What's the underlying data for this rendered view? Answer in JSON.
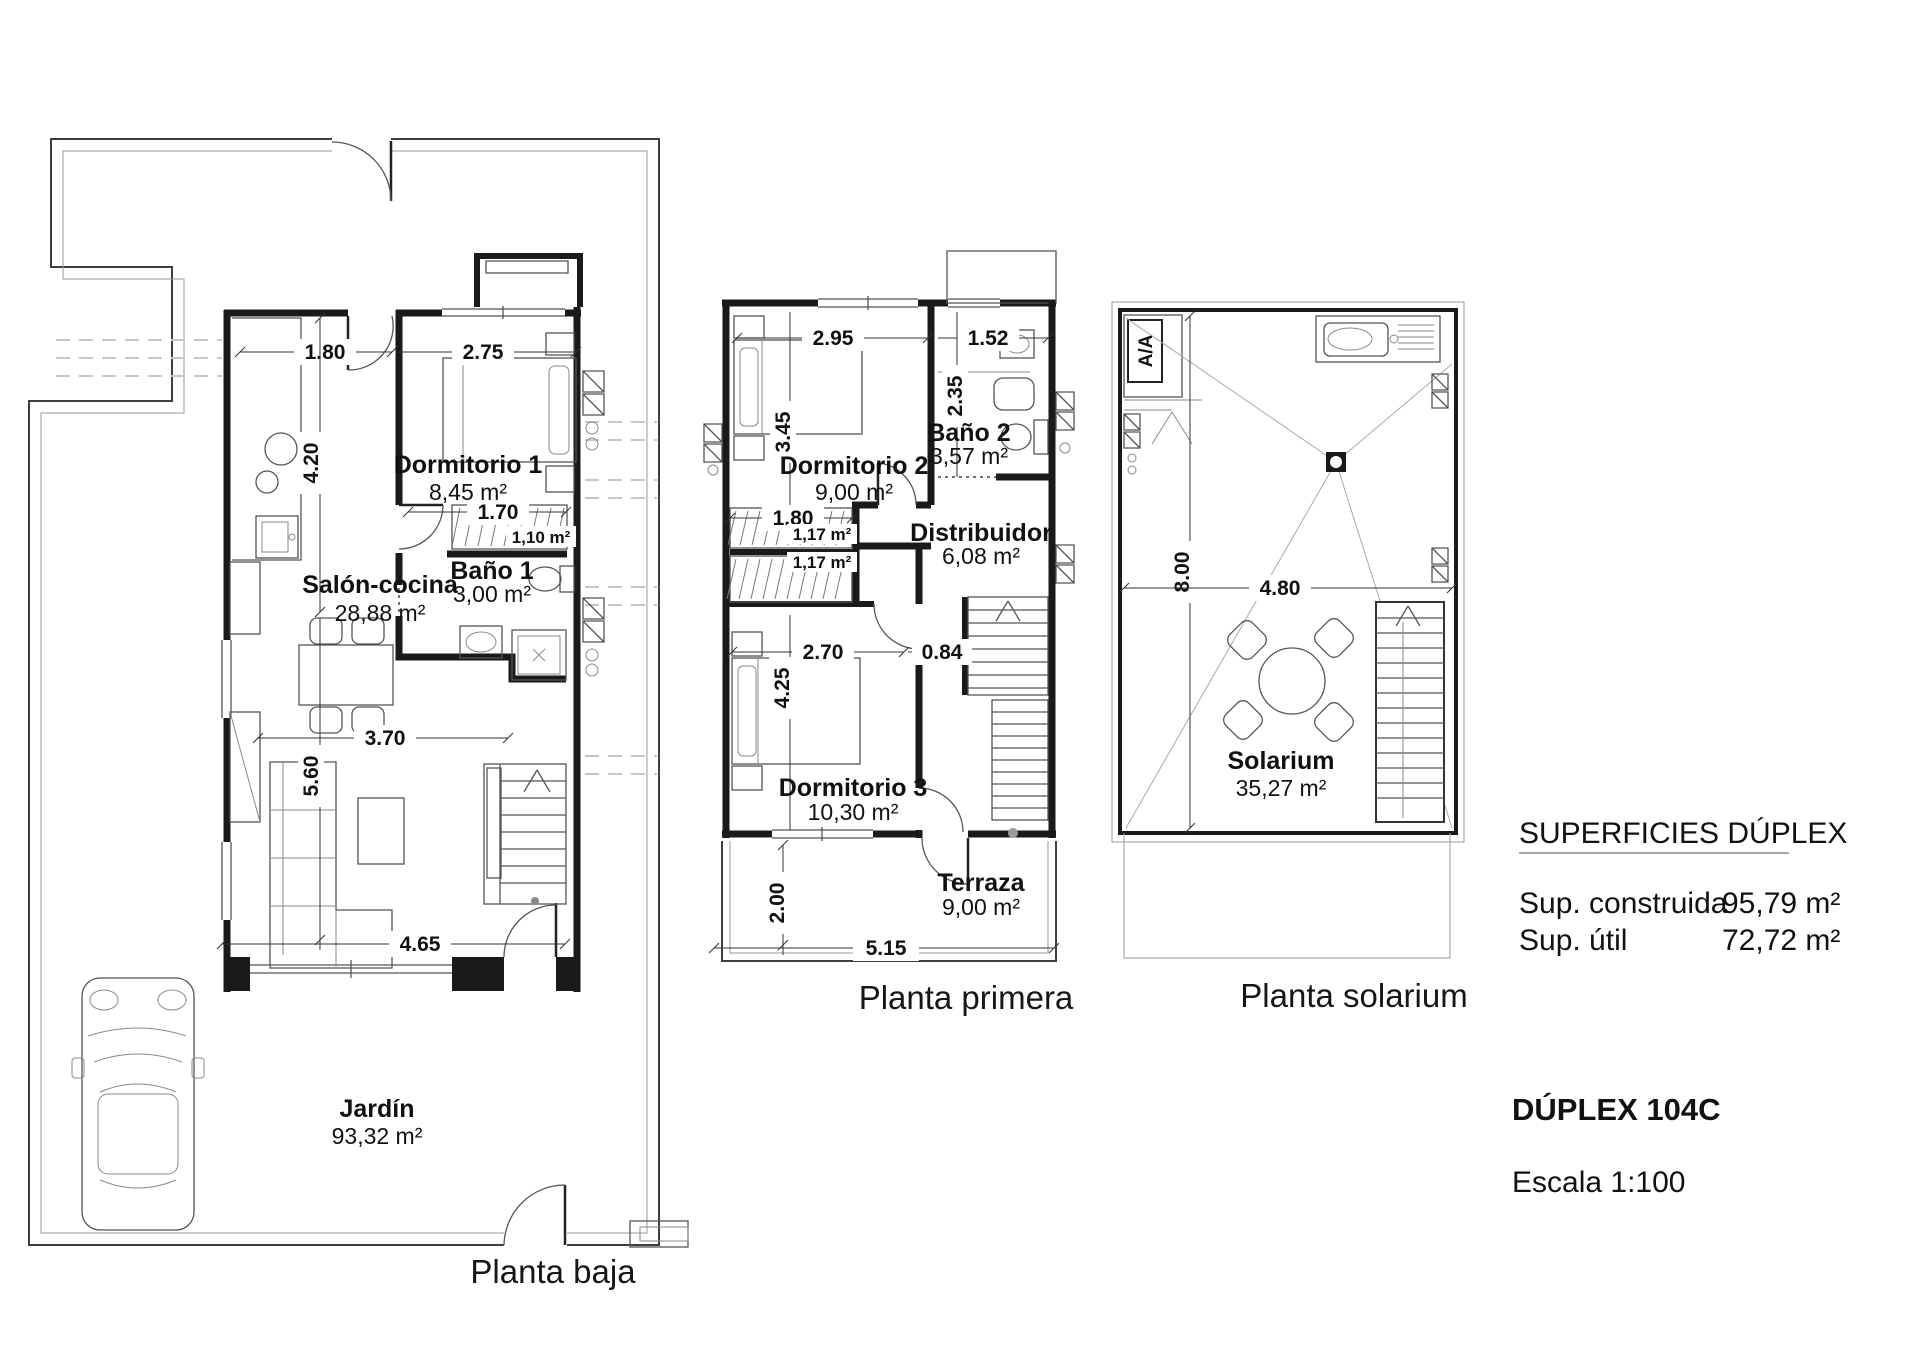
{
  "colors": {
    "wall": "#1a1a1a",
    "thin_line": "#555555",
    "dashed_line": "#c6c6c6",
    "background": "#ffffff"
  },
  "icons": [
    "car-plan-icon",
    "bed-icon",
    "sofa-icon",
    "dining-table-icon",
    "round-table-icon",
    "stairs-icon",
    "shower-icon",
    "toilet-icon",
    "washbasin-icon",
    "kitchen-sink-icon",
    "hob-icon",
    "door-arc-icon",
    "drain-icon",
    "ac-unit-icon"
  ],
  "plans": {
    "baja": {
      "title": "Planta baja",
      "rooms": {
        "dormitorio1": {
          "name": "Dormitorio 1",
          "area": "8,45 m²"
        },
        "bano1": {
          "name": "Baño 1",
          "area": "3,00 m²"
        },
        "salon": {
          "name": "Salón-cocina",
          "area": "28,88 m²"
        },
        "armario": {
          "area": "1,10 m²"
        },
        "jardin": {
          "name": "Jardín",
          "area": "93,32 m²"
        }
      },
      "dims": {
        "d180": "1.80",
        "d275": "2.75",
        "d420": "4.20",
        "d170": "1.70",
        "d370": "3.70",
        "d560": "5.60",
        "d465": "4.65"
      }
    },
    "primera": {
      "title": "Planta primera",
      "rooms": {
        "dormitorio2": {
          "name": "Dormitorio 2",
          "area": "9,00 m²"
        },
        "bano2": {
          "name": "Baño 2",
          "area": "3,57 m²"
        },
        "distribuidor": {
          "name": "Distribuidor",
          "area": "6,08 m²"
        },
        "armario1": {
          "area": "1,17 m²"
        },
        "armario2": {
          "area": "1,17 m²"
        },
        "dormitorio3": {
          "name": "Dormitorio 3",
          "area": "10,30 m²"
        },
        "terraza": {
          "name": "Terraza",
          "area": "9,00 m²"
        }
      },
      "dims": {
        "d295": "2.95",
        "d152": "1.52",
        "d345": "3.45",
        "d235": "2.35",
        "d180": "1.80",
        "d270": "2.70",
        "d084": "0.84",
        "d425": "4.25",
        "d200": "2.00",
        "d515": "5.15"
      }
    },
    "solarium": {
      "title": "Planta solarium",
      "rooms": {
        "solarium": {
          "name": "Solarium",
          "area": "35,27 m²"
        }
      },
      "labels": {
        "aa": "A/A"
      },
      "dims": {
        "d800": "8.00",
        "d480": "4.80"
      }
    }
  },
  "info": {
    "title": "SUPERFICIES DÚPLEX",
    "line1_label": "Sup. construida",
    "line1_value": "95,79 m²",
    "line2_label": "Sup. útil",
    "line2_value": "72,72 m²",
    "unit_name": "DÚPLEX 104C",
    "scale": "Escala 1:100"
  }
}
